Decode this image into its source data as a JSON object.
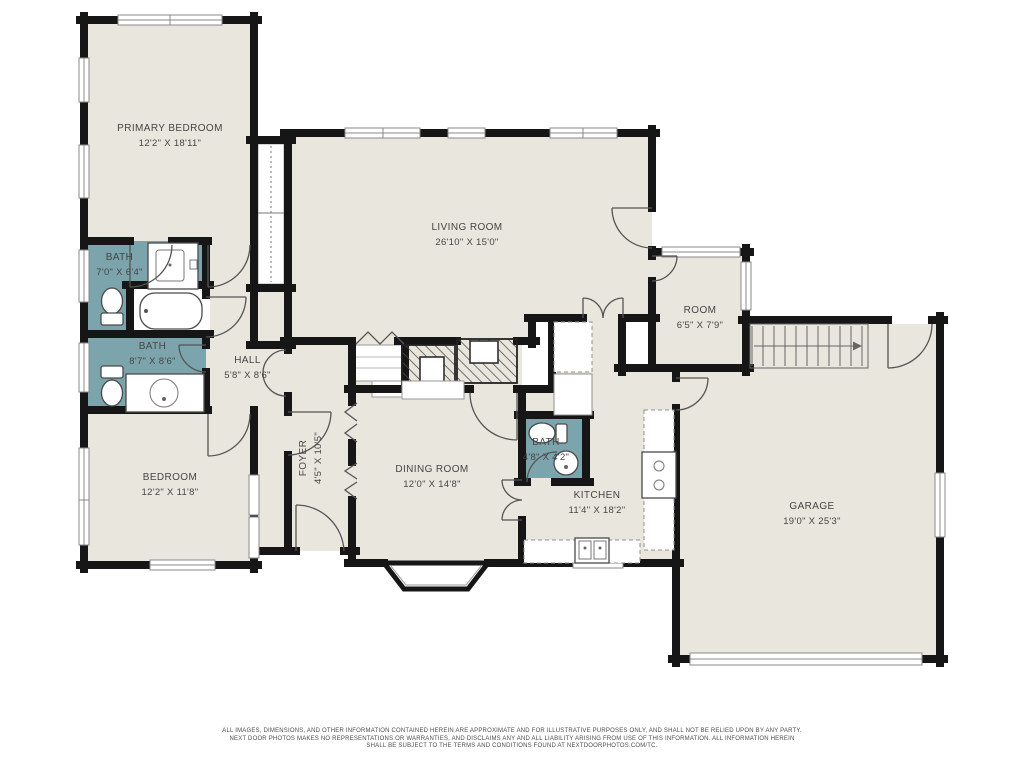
{
  "plan": {
    "rooms": {
      "primary_bedroom": {
        "name": "PRIMARY BEDROOM",
        "dims": "12'2\" X 18'11\""
      },
      "living_room": {
        "name": "LIVING ROOM",
        "dims": "26'10\" X 15'0\""
      },
      "bath_primary": {
        "name": "BATH",
        "dims": "7'0\" X 6'4\""
      },
      "bath_hall": {
        "name": "BATH",
        "dims": "8'7\" X 8'6\""
      },
      "hall": {
        "name": "HALL",
        "dims": "5'8\" X 8'6\""
      },
      "bedroom": {
        "name": "BEDROOM",
        "dims": "12'2\" X 11'8\""
      },
      "foyer": {
        "name": "FOYER",
        "dims": "4'5\" X 10'5\""
      },
      "dining_room": {
        "name": "DINING ROOM",
        "dims": "12'0\" X 14'8\""
      },
      "bath_small": {
        "name": "BATH",
        "dims": "4'8\" X 4'2\""
      },
      "kitchen": {
        "name": "KITCHEN",
        "dims": "11'4\" X 18'2\""
      },
      "room": {
        "name": "ROOM",
        "dims": "6'5\" X 7'9\""
      },
      "garage": {
        "name": "GARAGE",
        "dims": "19'0\" X 25'3\""
      }
    },
    "disclaimer": [
      "ALL IMAGES, DIMENSIONS, AND OTHER INFORMATION CONTAINED HEREIN ARE APPROXIMATE AND FOR ILLUSTRATIVE PURPOSES ONLY, AND SHALL NOT BE RELIED UPON BY ANY PARTY.",
      "NEXT DOOR PHOTOS MAKES NO REPRESENTATIONS OR WARRANTIES, AND DISCLAIMS ANY AND ALL LIABILITY ARISING FROM USE OF THIS INFORMATION. ALL INFORMATION HEREIN",
      "SHALL BE SUBJECT TO THE TERMS AND CONDITIONS FOUND AT NEXTDOORPHOTOS.COM/TC."
    ],
    "colors": {
      "wall": "#161616",
      "floor": "#e9e6dd",
      "bath_fill": "#7ba4ac",
      "window_frame": "#8a8a8a",
      "label_text": "#454545"
    }
  }
}
